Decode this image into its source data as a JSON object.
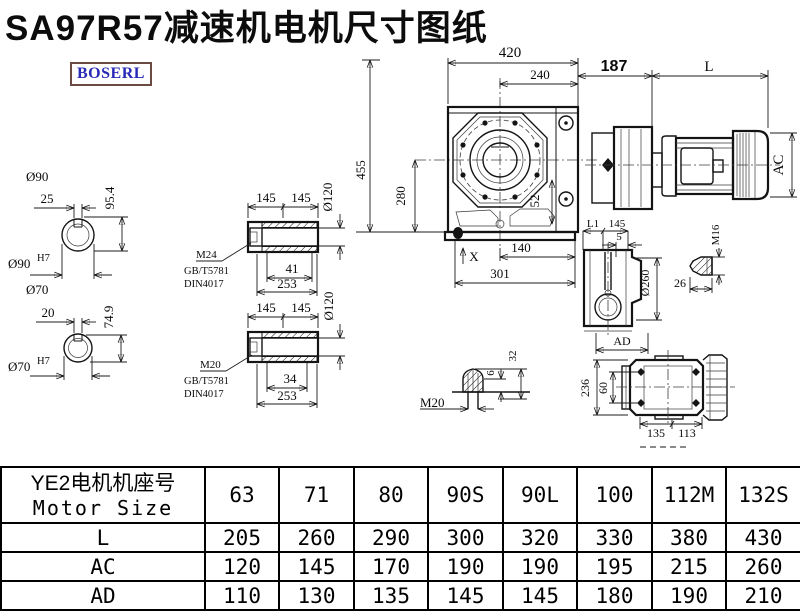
{
  "title": "SA97R57减速机电机尺寸图纸",
  "logo": "BOSERL",
  "colors": {
    "logo_text": "#2929b8",
    "logo_border": "#6a4a42",
    "drawing_line": "#141414"
  },
  "dims": {
    "front": {
      "w420": "420",
      "w240": "240",
      "h455": "455",
      "h280": "280",
      "h52": "52",
      "w140": "140",
      "w301": "301",
      "x_mark": "X"
    },
    "motor": {
      "w187": "187",
      "wl": "L",
      "ac": "AC"
    },
    "s90": {
      "dia": "Ø90",
      "key": "25",
      "height": "95.4",
      "bore": "Ø90",
      "fit": "H7"
    },
    "s70": {
      "dia": "Ø70",
      "key": "20",
      "height": "74.9",
      "bore": "Ø70",
      "fit": "H7"
    },
    "hs_top": {
      "len_a": "145",
      "len_b": "145",
      "dia": "Ø120",
      "thread": "M24",
      "std1": "GB/T5781",
      "std2": "DIN4017",
      "depth": "41",
      "total": "253"
    },
    "hs_bot": {
      "len_a": "145",
      "len_b": "145",
      "dia": "Ø120",
      "thread": "M20",
      "std1": "GB/T5781",
      "std2": "DIN4017",
      "depth": "34",
      "total": "253"
    },
    "side": {
      "l1": "L1",
      "w145": "145",
      "w5": "5",
      "dia": "Ø260",
      "ad": "AD"
    },
    "m16": {
      "thread": "M16",
      "len": "26"
    },
    "m20": {
      "thread": "M20",
      "h6": "6",
      "h32": "32"
    },
    "top": {
      "h236": "236",
      "h60": "60",
      "w135": "135",
      "w113": "113"
    }
  },
  "table": {
    "header": {
      "line1": "YE2电机机座号",
      "line2": "Motor Size"
    },
    "columns": [
      "63",
      "71",
      "80",
      "90S",
      "90L",
      "100",
      "112M",
      "132S"
    ],
    "rows": [
      {
        "label": "L",
        "values": [
          "205",
          "260",
          "290",
          "300",
          "320",
          "330",
          "380",
          "430"
        ]
      },
      {
        "label": "AC",
        "values": [
          "120",
          "145",
          "170",
          "190",
          "190",
          "195",
          "215",
          "260"
        ]
      },
      {
        "label": "AD",
        "values": [
          "110",
          "130",
          "135",
          "145",
          "145",
          "180",
          "190",
          "210"
        ]
      }
    ]
  }
}
